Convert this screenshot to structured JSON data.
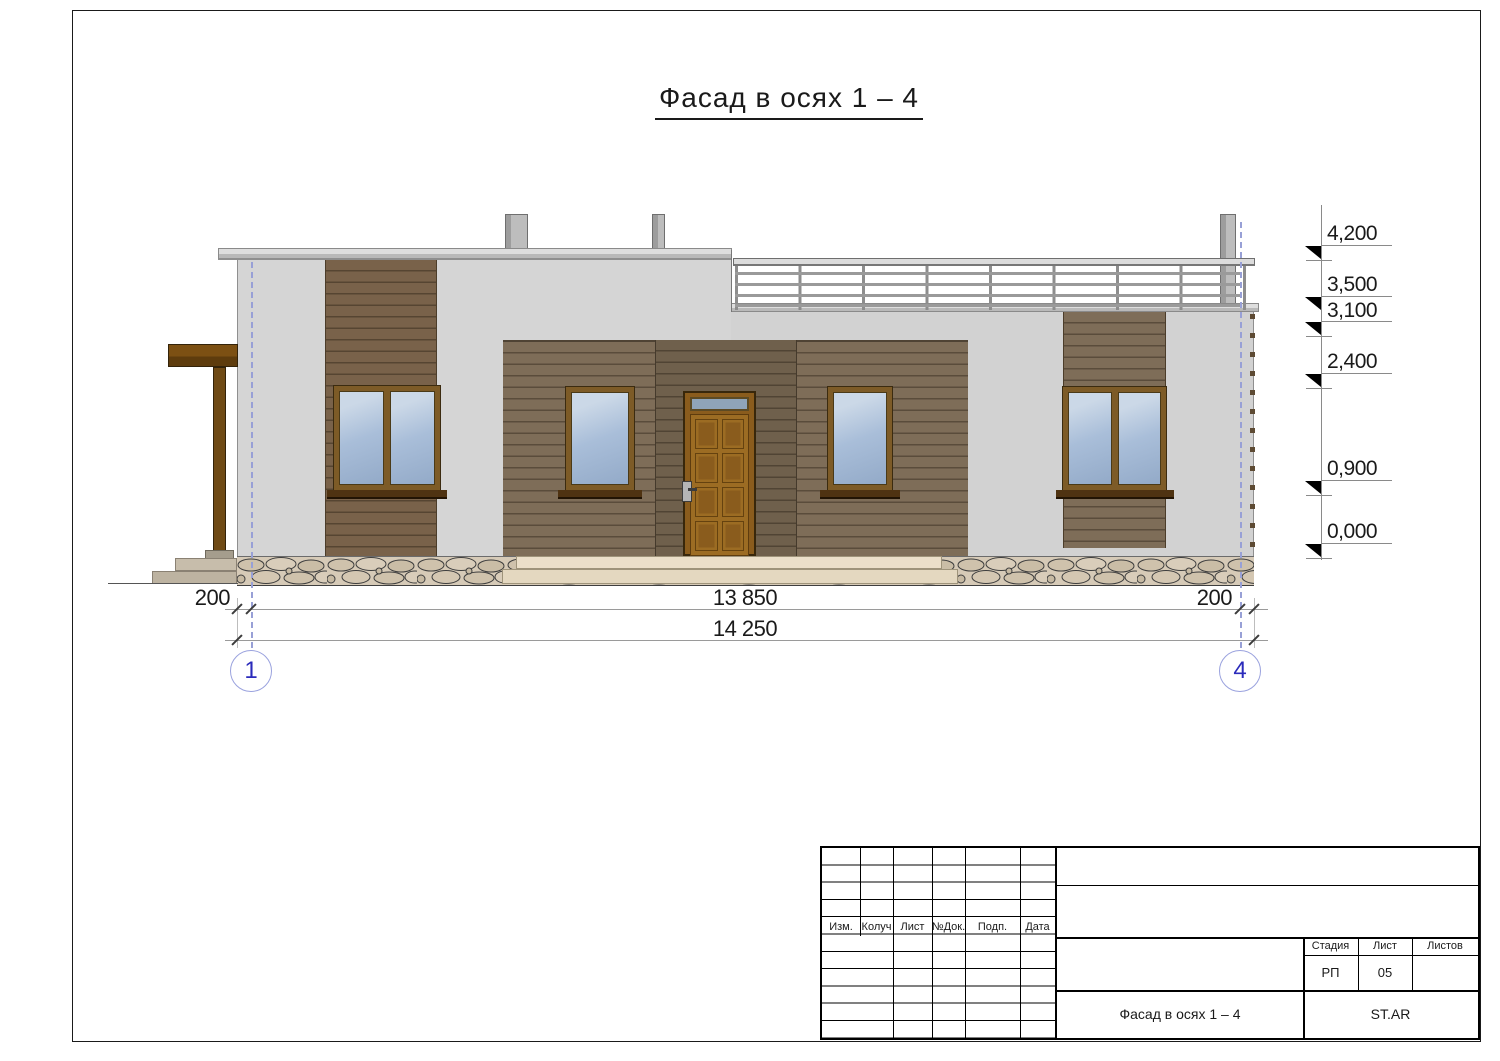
{
  "page": {
    "title": "Фасад в осях 1 – 4"
  },
  "drawing": {
    "axes": [
      {
        "id": "1"
      },
      {
        "id": "4"
      }
    ],
    "dimensions": {
      "left_offset": "200",
      "between_axes": "13 850",
      "right_offset": "200",
      "total": "14 250"
    },
    "elevations": [
      {
        "label": "4,200"
      },
      {
        "label": "3,500"
      },
      {
        "label": "3,100"
      },
      {
        "label": "2,400"
      },
      {
        "label": "0,900"
      },
      {
        "label": "0,000"
      }
    ]
  },
  "title_block": {
    "columns": [
      {
        "label": "Изм."
      },
      {
        "label": "Колуч"
      },
      {
        "label": "Лист"
      },
      {
        "label": "№Док."
      },
      {
        "label": "Подп."
      },
      {
        "label": "Дата"
      }
    ],
    "stage_label": "Стадия",
    "sheet_label": "Лист",
    "sheets_label": "Листов",
    "stage": "РП",
    "sheet": "05",
    "doc_title": "Фасад в осях 1 – 4",
    "code": "ST.AR"
  },
  "colors": {
    "wall_grey": "#d5d5d5",
    "wood_brown": "#7e6d58",
    "dark_wood": "#6f604c",
    "door_brown": "#9c6c23",
    "glass_blue": "#a9bed9",
    "axis_blue": "#2b2bbb",
    "stone_beige": "#d6cab7"
  }
}
